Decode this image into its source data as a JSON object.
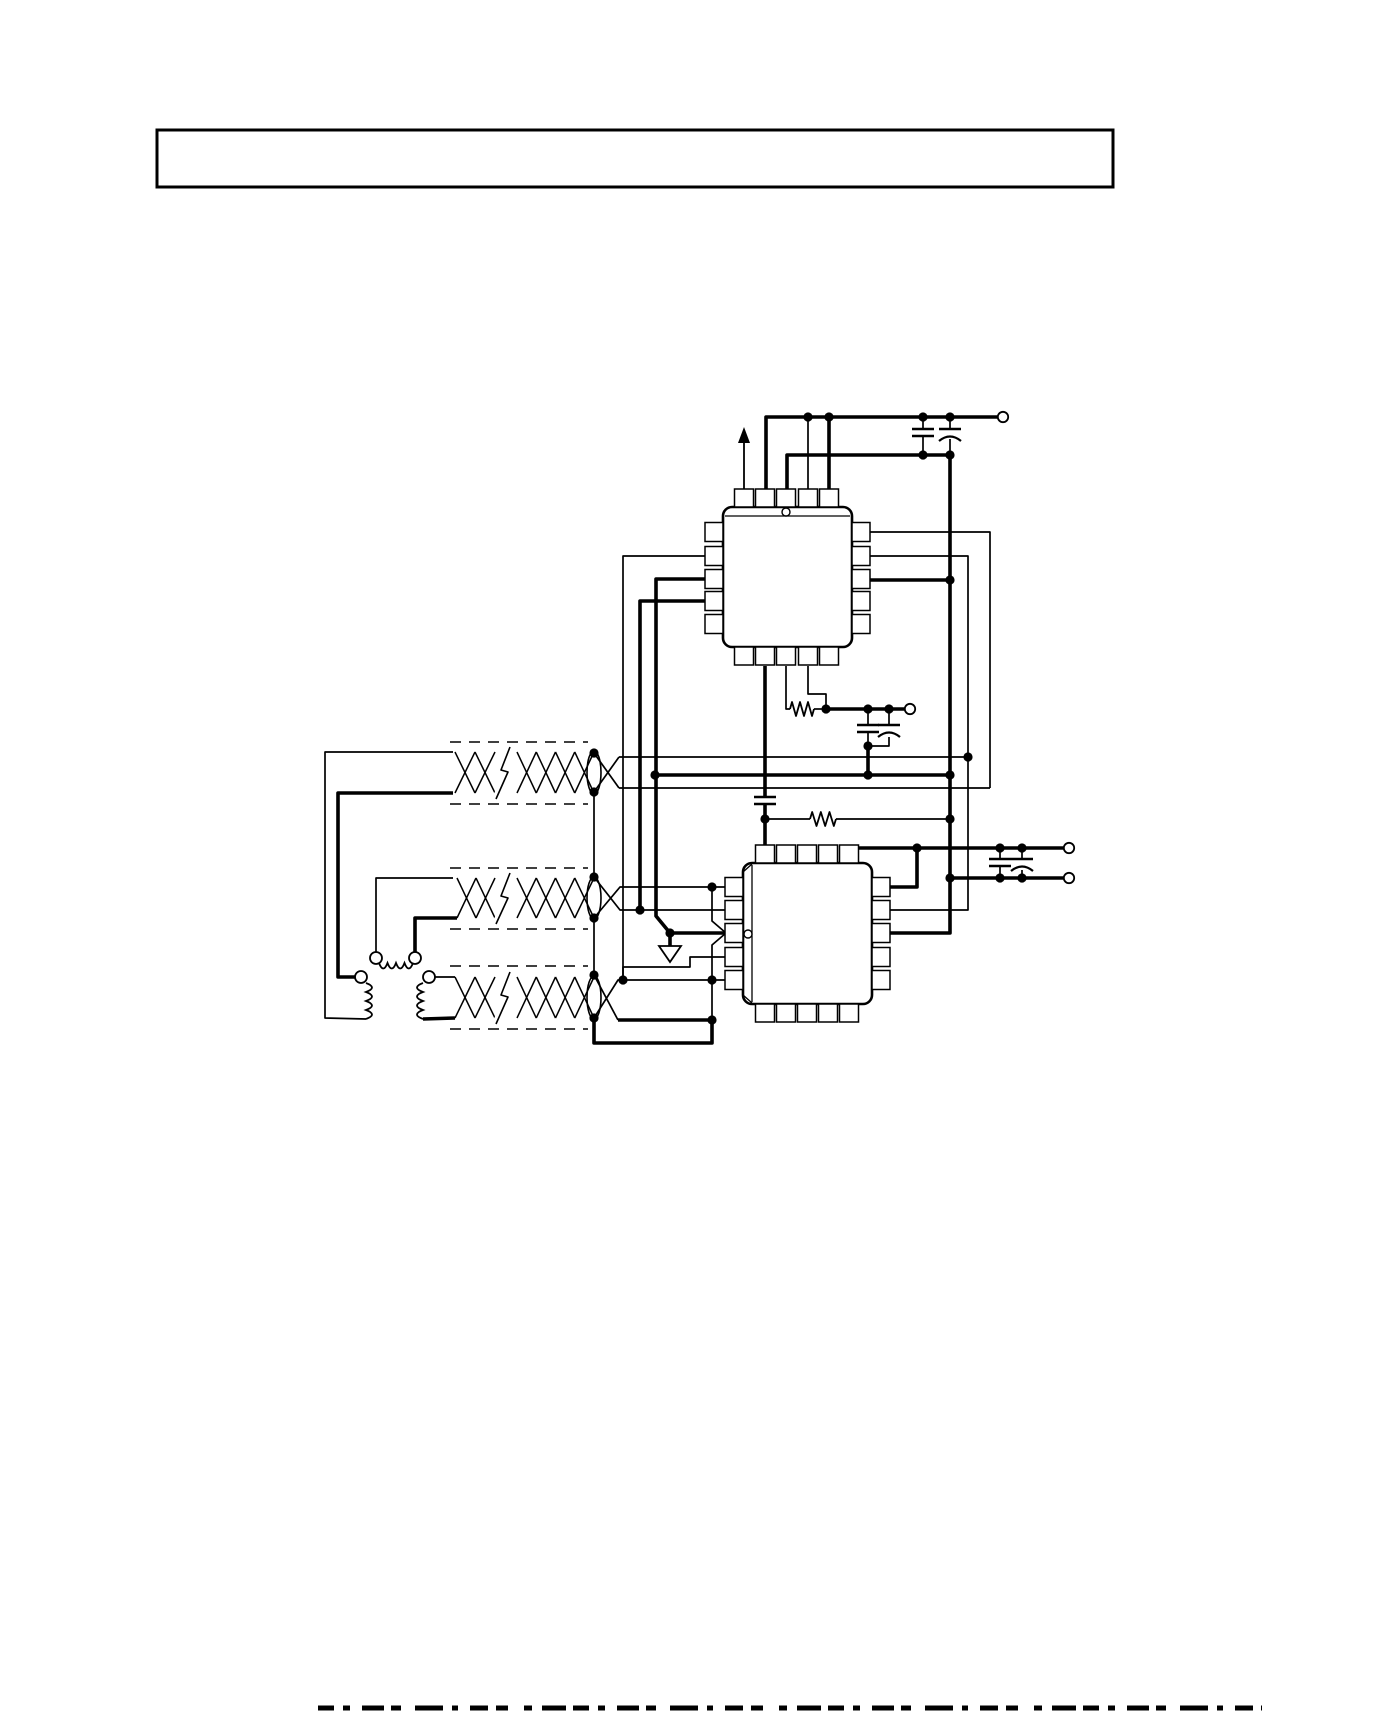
{
  "page": {
    "width": 1399,
    "height": 1711,
    "bg": "#ffffff",
    "ink": "#000000"
  },
  "header": {
    "text": "",
    "box": {
      "x": 157,
      "y": 130,
      "w": 956,
      "h": 57,
      "stroke": 3
    }
  },
  "footer": {
    "y": 1708,
    "x1": 318,
    "x2": 1262,
    "stroke": 5,
    "dash": "16 9 7 12 22 7 10 14 28 9 6 12 18 8 12 16 8 10 24 7"
  },
  "schematic": {
    "ics": [
      {
        "id": "ic-top",
        "x": 723,
        "y": 507,
        "w": 129,
        "h": 140,
        "pins_top": [
          744,
          765,
          786,
          808,
          829
        ],
        "pins_bottom": [
          744,
          765,
          786,
          808,
          829
        ],
        "pins_left": [
          532,
          556,
          579,
          601,
          624
        ],
        "pins_right": [
          532,
          556,
          579,
          601,
          624
        ],
        "pin_len": 18,
        "pin_w": 19,
        "mark": {
          "side": "top",
          "line": 516,
          "circle": [
            786,
            512
          ]
        },
        "bevels": []
      },
      {
        "id": "ic-bottom",
        "x": 743,
        "y": 863,
        "w": 129,
        "h": 141,
        "pins_top": [
          765,
          786,
          807,
          828,
          849
        ],
        "pins_bottom": [
          765,
          786,
          807,
          828,
          849
        ],
        "pins_left": [
          887,
          910,
          933,
          957,
          980
        ],
        "pins_right": [
          887,
          910,
          933,
          957,
          980
        ],
        "pin_len": 18,
        "pin_w": 19,
        "mark": {
          "side": "left",
          "line": 752,
          "circle": [
            748,
            934
          ]
        },
        "bevels": [
          [
            743,
            872,
            752,
            864
          ],
          [
            743,
            995,
            752,
            1003
          ]
        ]
      }
    ],
    "wires_thin": [
      "808,489 808,417",
      "870,532 990,532 990,788",
      "870,556 968,556 968,910 890,910",
      "705,556 623,556 623,980",
      "786,666 786,709 790,709",
      "808,666 808,694 826,694 826,709",
      "814,709 826,709",
      "765,819 810,819",
      "836,819 950,819",
      "868,709 868,725",
      "868,732 868,746",
      "889,709 889,725",
      "889,737 889,746 868,746",
      "923,417 923,429",
      "923,436 923,455",
      "950,417 950,429",
      "950,439 950,455",
      "1000,848 1000,859",
      "1000,866 1000,878",
      "1022,848 1022,859",
      "1022,870 1022,878",
      "594,753 619,788",
      "594,792 619,757",
      "619,757 968,757",
      "619,788 990,788",
      "594,877 620,910 725,910",
      "594,918 620,887 725,887",
      "712,887 712,921 726,933 712,945 712,1020",
      "623,980 623,967 690,967 690,957 725,957",
      "594,975 618,1020",
      "594,1018 618,980 623,980",
      "623,980 712,980 725,980",
      "594,792 594,877",
      "594,918 594,975",
      "453,752 325,752 325,1018 366,1019",
      "376,952 376,878 453,878",
      "435,977 455,977"
    ],
    "wires_thick": [
      "766,489 766,417 998,417",
      "787,489 787,455 950,455",
      "829,489 829,417",
      "950,455 950,933 890,933",
      "870,580 950,580",
      "705,601 640,601 640,910",
      "705,579 656,579 656,916 670,933 725,933",
      "670,933 670,946",
      "765,666 765,797",
      "765,804 765,845",
      "826,709 905,709",
      "868,746 868,775",
      "655,775 950,775",
      "858,848 1064,848",
      "950,878 1064,878",
      "890,887 917,887 917,848",
      "453,793 338,793 338,977 355,977",
      "415,952 415,918 457,918",
      "423,1019 455,1018",
      "618,1020 712,1020",
      "712,1020 712,1043 594,1043 594,1018"
    ],
    "junctions": [
      [
        808,
        417
      ],
      [
        829,
        417
      ],
      [
        923,
        417
      ],
      [
        950,
        417
      ],
      [
        923,
        455
      ],
      [
        950,
        455
      ],
      [
        950,
        580
      ],
      [
        950,
        775
      ],
      [
        950,
        819
      ],
      [
        950,
        878
      ],
      [
        826,
        709
      ],
      [
        868,
        709
      ],
      [
        889,
        709
      ],
      [
        868,
        746
      ],
      [
        655,
        775
      ],
      [
        868,
        775
      ],
      [
        765,
        819
      ],
      [
        917,
        848
      ],
      [
        1000,
        848
      ],
      [
        1022,
        848
      ],
      [
        1000,
        878
      ],
      [
        1022,
        878
      ],
      [
        594,
        753
      ],
      [
        594,
        792
      ],
      [
        594,
        877
      ],
      [
        594,
        918
      ],
      [
        594,
        975
      ],
      [
        594,
        1018
      ],
      [
        640,
        910
      ],
      [
        670,
        933
      ],
      [
        712,
        887
      ],
      [
        712,
        980
      ],
      [
        623,
        980
      ],
      [
        712,
        1020
      ],
      [
        968,
        757
      ]
    ],
    "terminals": [
      [
        1003,
        417
      ],
      [
        910,
        709
      ],
      [
        1069,
        848
      ],
      [
        1069,
        878
      ]
    ],
    "winding_terminals": [
      [
        376,
        958
      ],
      [
        415,
        958
      ],
      [
        361,
        977
      ],
      [
        429,
        977
      ]
    ],
    "resistors": [
      {
        "x1": 790,
        "x2": 814,
        "y": 709
      },
      {
        "x1": 810,
        "x2": 836,
        "y": 819
      }
    ],
    "capacitors": [
      {
        "x": 923,
        "y": 429,
        "kind": "flat"
      },
      {
        "x": 950,
        "y": 429,
        "kind": "curved"
      },
      {
        "x": 765,
        "y": 797,
        "kind": "flat"
      },
      {
        "x": 868,
        "y": 725,
        "kind": "flat"
      },
      {
        "x": 889,
        "y": 725,
        "kind": "curved"
      },
      {
        "x": 1000,
        "y": 859,
        "kind": "flat"
      },
      {
        "x": 1022,
        "y": 859,
        "kind": "curved"
      }
    ],
    "coils": [
      {
        "kind": "v",
        "x": 366,
        "y1": 983,
        "y2": 1019,
        "bulge": 12,
        "n": 4
      },
      {
        "kind": "v",
        "x": 423,
        "y1": 983,
        "y2": 1019,
        "bulge": -12,
        "n": 4
      },
      {
        "kind": "h",
        "y": 963,
        "x1": 379,
        "x2": 413,
        "bulge": 11,
        "n": 4
      }
    ],
    "twisted_pairs": [
      {
        "x0": 455,
        "g1": 495,
        "g2": 517,
        "x1": 594,
        "yt": 752,
        "yb": 793
      },
      {
        "x0": 457,
        "g1": 495,
        "g2": 517,
        "x1": 594,
        "yt": 878,
        "yb": 918
      },
      {
        "x0": 455,
        "g1": 495,
        "g2": 517,
        "x1": 594,
        "yt": 977,
        "yb": 1018
      }
    ],
    "shield_dashes": [
      {
        "x0": 450,
        "x1": 588,
        "y": 742
      },
      {
        "x0": 450,
        "x1": 588,
        "y": 804
      },
      {
        "x0": 450,
        "x1": 588,
        "y": 868
      },
      {
        "x0": 450,
        "x1": 588,
        "y": 929
      },
      {
        "x0": 450,
        "x1": 588,
        "y": 966
      },
      {
        "x0": 450,
        "x1": 588,
        "y": 1029
      }
    ],
    "breaks": [
      {
        "pts": "510,747 501,770 508,772 496,799"
      },
      {
        "pts": "510,873 501,896 508,898 496,924"
      },
      {
        "pts": "510,972 501,995 508,997 496,1024"
      }
    ],
    "ground": {
      "pts": "659,946 681,946 670,962"
    },
    "arrow": {
      "x": 744,
      "y1": 489,
      "y2": 441,
      "tip": 427,
      "half": 6
    }
  }
}
